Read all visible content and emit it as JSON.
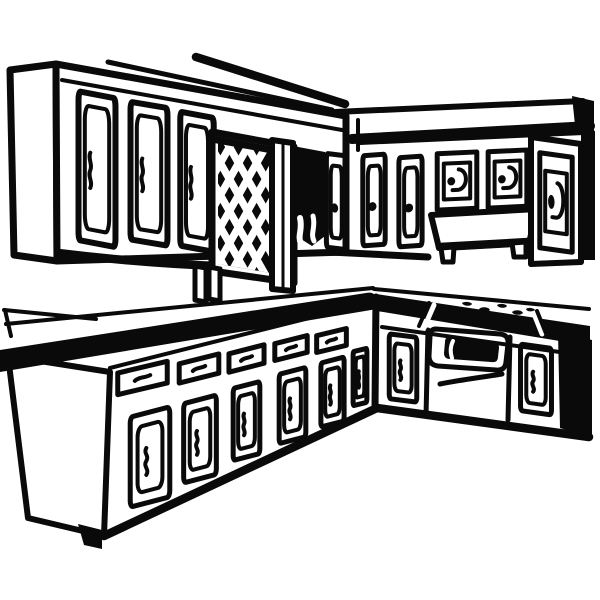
{
  "image": {
    "alt": "Black-and-white line-art illustration of an L-shaped kitchen: upper wall cabinets, a lattice-front cabinet door, a range hood, a tall cabinet, an L-shaped countertop with sink marks and cooktop burners, base cabinets with drawers, and a built-in oven."
  },
  "colors": {
    "ink": "#0a0a0a",
    "paper": "#ffffff"
  },
  "elements": [
    "ceiling-lines",
    "upper-cabinets-left",
    "upper-cabinet-door",
    "lattice-cabinet-door",
    "window-posts",
    "corner-pillar",
    "doorway-shadow",
    "upper-cabinets-right",
    "range-hood",
    "tall-cabinet",
    "countertop-left",
    "countertop-right",
    "sink-marks",
    "cooktop-burners",
    "base-cabinets-left",
    "drawer-front",
    "base-cabinet-door",
    "oven",
    "oven-window",
    "oven-drawer",
    "toe-kick"
  ]
}
